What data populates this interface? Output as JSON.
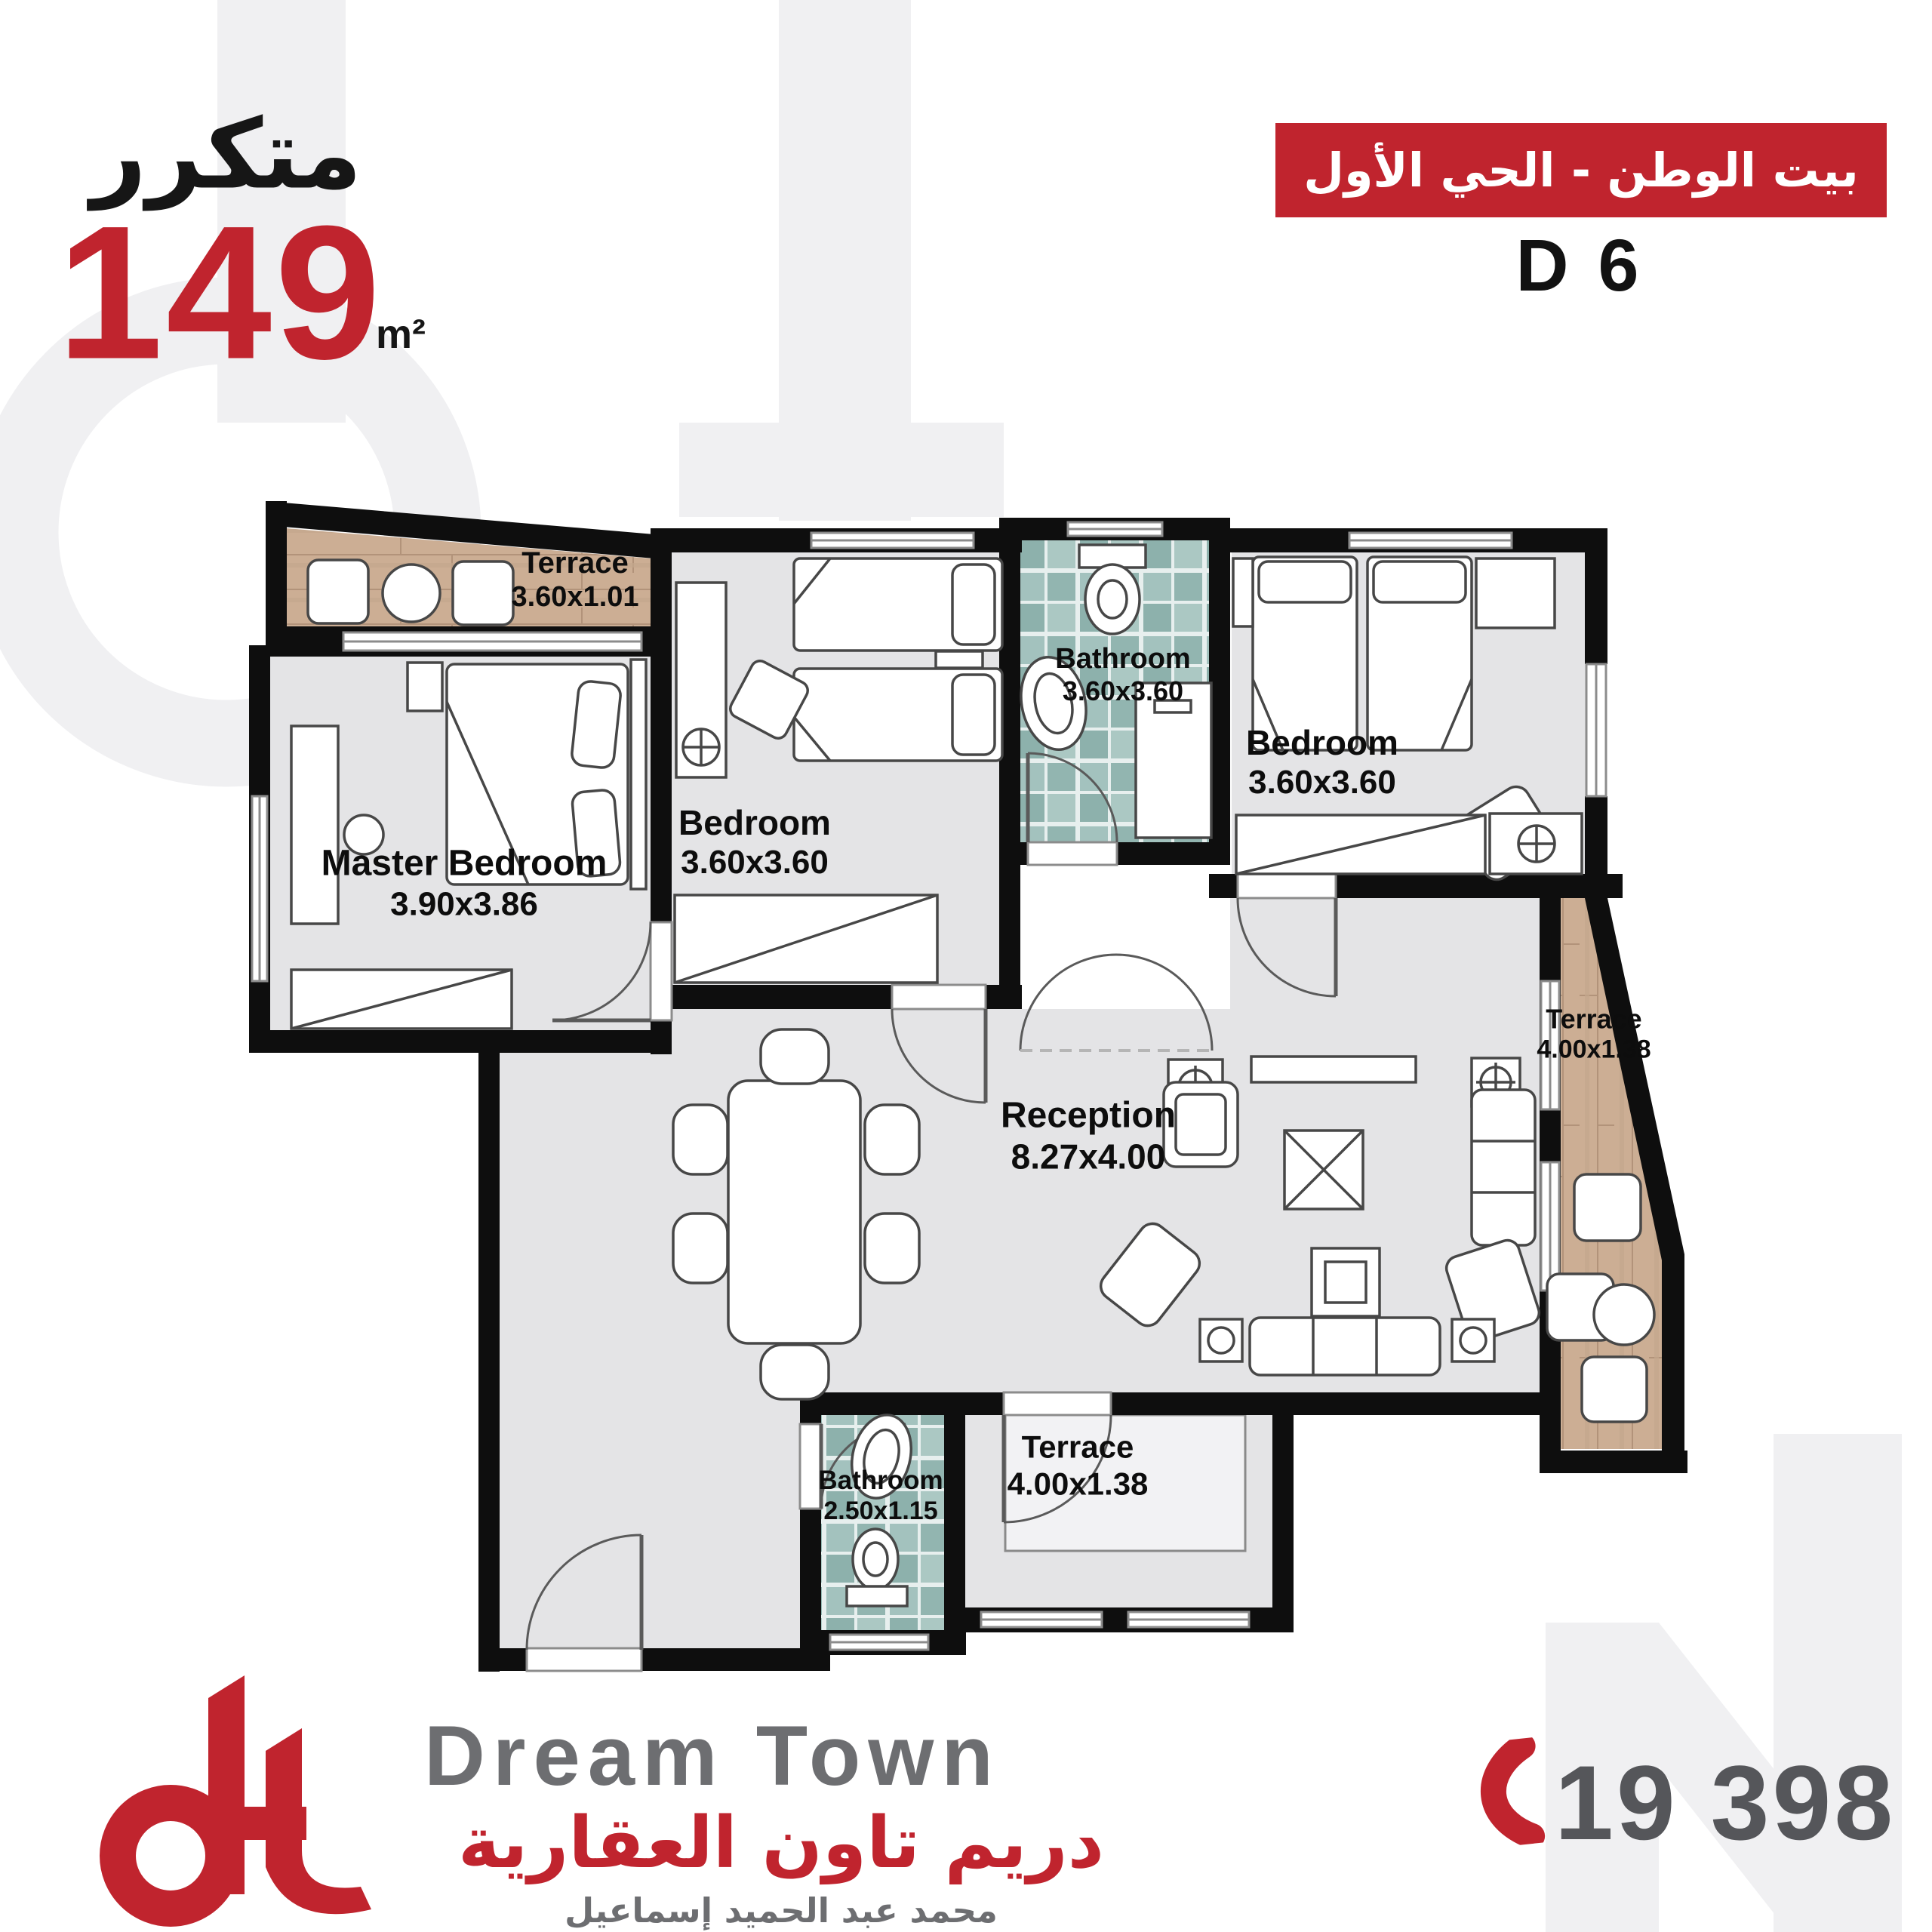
{
  "header": {
    "unit_type_ar": "متكرر",
    "area_value": "149",
    "area_unit": "m²",
    "project_banner_ar": "بيت الوطن - الحي الأول",
    "unit_code": "D 6"
  },
  "plan": {
    "rooms": [
      {
        "id": "terrace-top",
        "name": "Terrace",
        "dims": "3.60x1.01"
      },
      {
        "id": "master-bedroom",
        "name": "Master Bedroom",
        "dims": "3.90x3.86"
      },
      {
        "id": "bedroom-middle",
        "name": "Bedroom",
        "dims": "3.60x3.60"
      },
      {
        "id": "bathroom-top",
        "name": "Bathroom",
        "dims": "3.60x3.60"
      },
      {
        "id": "bedroom-right",
        "name": "Bedroom",
        "dims": "3.60x3.60"
      },
      {
        "id": "reception",
        "name": "Reception",
        "dims": "8.27x4.00"
      },
      {
        "id": "terrace-right",
        "name": "Terrace",
        "dims": "4.00x1.38"
      },
      {
        "id": "bathroom-bottom",
        "name": "Bathroom",
        "dims": "2.50x1.15"
      },
      {
        "id": "terrace-bottom",
        "name": "Terrace",
        "dims": "4.00x1.38"
      }
    ]
  },
  "footer": {
    "logo_en": "Dream Town",
    "logo_ar": "دريم تاون العقارية",
    "owner_ar": "محمد عبد الحميد إسماعيل",
    "phone": "19 398"
  },
  "colors": {
    "brand_red": "#c0242e",
    "wall_black": "#0e0e0e",
    "room_gray": "#e4e4e6",
    "wood_tan": "#cdb199",
    "tile_teal": "#9dbfbc",
    "logo_gray": "#6d6e71",
    "phone_gray": "#55565a",
    "watermark_gray": "#f0f0f2"
  }
}
